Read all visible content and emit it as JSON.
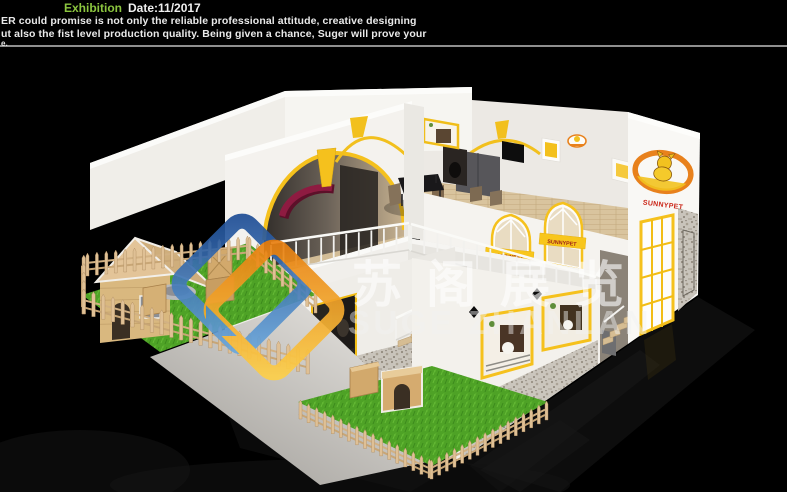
{
  "header": {
    "highlight": "Exhibition",
    "date": "Date:11/2017",
    "tagline1": "ER could promise is not only the reliable professional attitude, creative designing",
    "tagline2": "ut also the fist level production quality. Being given a chance, Suger will prove your",
    "tagline3": "e.",
    "highlight_color": "#8cc63f",
    "divider_color": "#8f8f8f"
  },
  "watermark": {
    "text_cn": "苏阁展览",
    "text_en": "SUGE ZHANLAN",
    "logo_blue": "#2f62a8",
    "logo_orange": "#f59a1f"
  },
  "booth": {
    "brand_side_logo": "SUNNYPET",
    "banner1": "SUNNYPET",
    "banner2": "SUNNYPET",
    "accent_yellow": "#f5c11d",
    "maroon": "#8e1b41",
    "grass_green": "#4ea226",
    "wood": "#d8c29c",
    "stone": "#b7b2a9",
    "floor_black": "#000000"
  }
}
